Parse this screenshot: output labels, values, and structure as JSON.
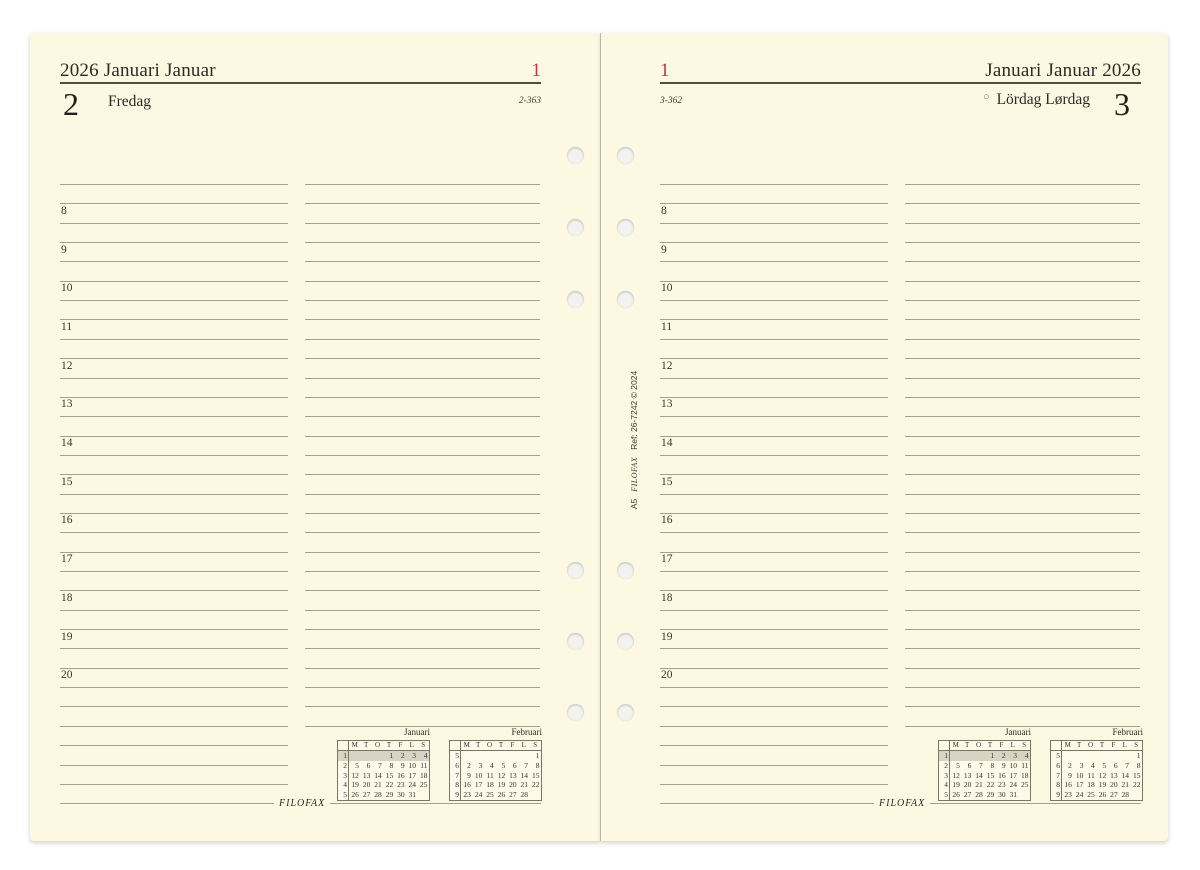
{
  "pages": {
    "left": {
      "header_title": "2026 Januari Januar",
      "week_number": "1",
      "day_number": "2",
      "day_name": "Fredag",
      "day_of_year": "2-363",
      "logo": "filofax"
    },
    "right": {
      "week_number": "1",
      "header_title": "Januari Januar 2026",
      "day_of_year": "3-362",
      "moon_symbol": "○",
      "day_name": "Lördag Lørdag",
      "day_number": "3",
      "logo": "filofax"
    }
  },
  "schedule": {
    "hours": [
      "8",
      "9",
      "10",
      "11",
      "12",
      "13",
      "14",
      "15",
      "16",
      "17",
      "18",
      "19",
      "20"
    ]
  },
  "mini_calendars": [
    {
      "title": "Januari",
      "day_headers": [
        "M",
        "T",
        "O",
        "T",
        "F",
        "L",
        "S"
      ],
      "weeks": [
        {
          "num": "1",
          "days": [
            "",
            "",
            "",
            "1",
            "2",
            "3",
            "4"
          ],
          "highlight": true
        },
        {
          "num": "2",
          "days": [
            "5",
            "6",
            "7",
            "8",
            "9",
            "10",
            "11"
          ],
          "highlight": false
        },
        {
          "num": "3",
          "days": [
            "12",
            "13",
            "14",
            "15",
            "16",
            "17",
            "18"
          ],
          "highlight": false
        },
        {
          "num": "4",
          "days": [
            "19",
            "20",
            "21",
            "22",
            "23",
            "24",
            "25"
          ],
          "highlight": false
        },
        {
          "num": "5",
          "days": [
            "26",
            "27",
            "28",
            "29",
            "30",
            "31",
            ""
          ],
          "highlight": false
        }
      ]
    },
    {
      "title": "Februari",
      "day_headers": [
        "M",
        "T",
        "O",
        "T",
        "F",
        "L",
        "S"
      ],
      "weeks": [
        {
          "num": "5",
          "days": [
            "",
            "",
            "",
            "",
            "",
            "",
            "1"
          ],
          "highlight": false
        },
        {
          "num": "6",
          "days": [
            "2",
            "3",
            "4",
            "5",
            "6",
            "7",
            "8"
          ],
          "highlight": false
        },
        {
          "num": "7",
          "days": [
            "9",
            "10",
            "11",
            "12",
            "13",
            "14",
            "15"
          ],
          "highlight": false
        },
        {
          "num": "8",
          "days": [
            "16",
            "17",
            "18",
            "19",
            "20",
            "21",
            "22"
          ],
          "highlight": false
        },
        {
          "num": "9",
          "days": [
            "23",
            "24",
            "25",
            "26",
            "27",
            "28",
            ""
          ],
          "highlight": false
        }
      ]
    }
  ],
  "spine": {
    "size_label": "A5",
    "brand": "filofax",
    "ref": "Ref: 26-7242 © 2024"
  },
  "colors": {
    "page_bg": "#fcf8e2",
    "ruled_line": "#a5a189",
    "header_rule": "#514e41",
    "text": "#2c2b24",
    "accent_red": "#b43a50",
    "calendar_highlight": "#d8d4c3"
  }
}
